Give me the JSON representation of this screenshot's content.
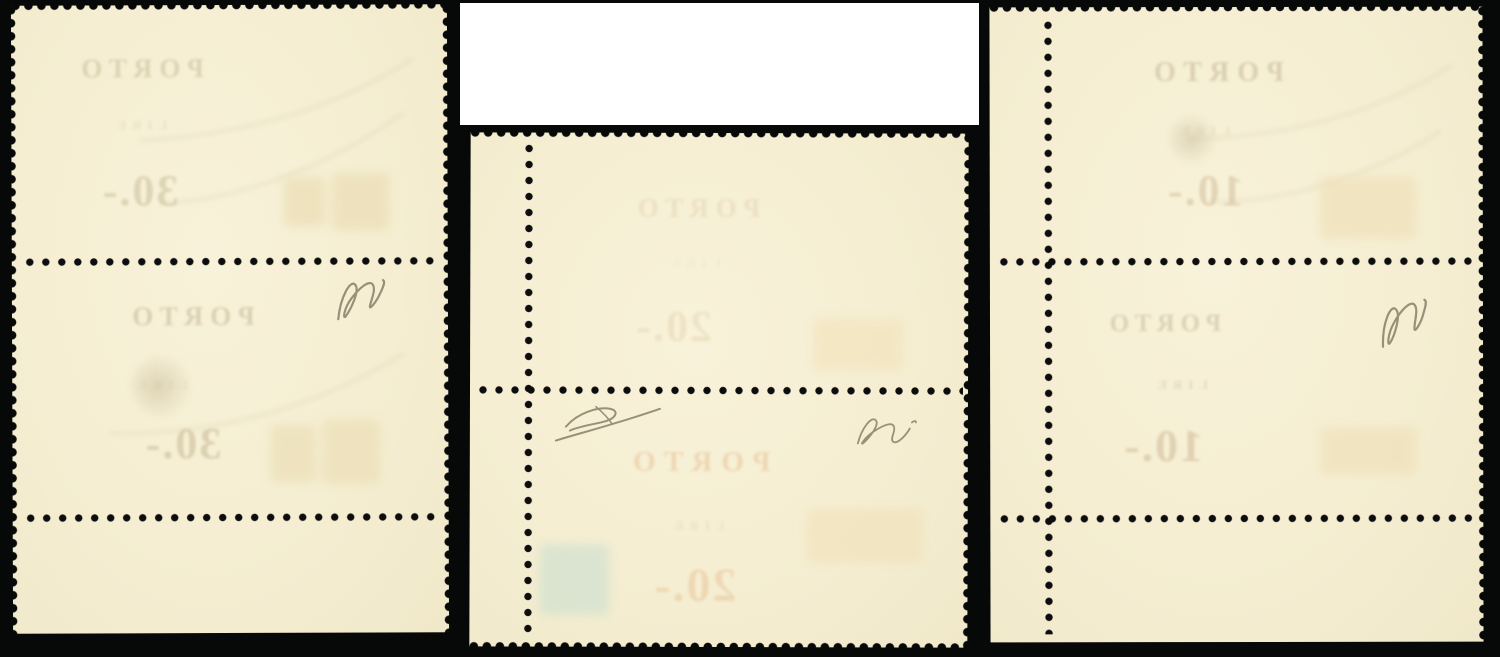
{
  "scene": {
    "description": "photograph of three mint stamp vertical pairs seen from the back (gum side) laid on a black background; mirrored PORTO overprints show through the paper",
    "colors": {
      "background": "#070808",
      "paper": "#f5eed2",
      "perforation_dots": "#0d0d0e",
      "white_cover_block": "#ffffff",
      "pencil_mark": "#9a907a",
      "showthrough_warm": "#c9bc9a",
      "showthrough_orange": "#ecca9f",
      "showthrough_bluegreen": "#cde0d0"
    }
  },
  "white_block": {
    "note": ""
  },
  "pieces": [
    {
      "label": "left vertical pair with bottom sheet margin",
      "stamps": [
        {
          "line1": "PORTO",
          "line2": "LIRE",
          "value": "30.-"
        },
        {
          "line1": "PORTO",
          "line2": "LIRE",
          "value": "30.-"
        }
      ],
      "signature_icon": "pencil-expert-signature"
    },
    {
      "label": "middle vertical pair with left sheet margin",
      "stamps": [
        {
          "line1": "PORTO",
          "line2": "LIRE",
          "value": "20.-"
        },
        {
          "line1": "PORTO",
          "line2": "LIRE",
          "value": "20.-"
        }
      ],
      "signature_icons": [
        "pencil-expert-signature",
        "pencil-expert-signature"
      ]
    },
    {
      "label": "right vertical pair with left sheet margin",
      "stamps": [
        {
          "line1": "PORTO",
          "line2": "LIRE",
          "value": "10.-"
        },
        {
          "line1": "PORTO",
          "line2": "LIRE",
          "value": "10.-"
        }
      ],
      "signature_icon": "pencil-expert-signature"
    }
  ]
}
